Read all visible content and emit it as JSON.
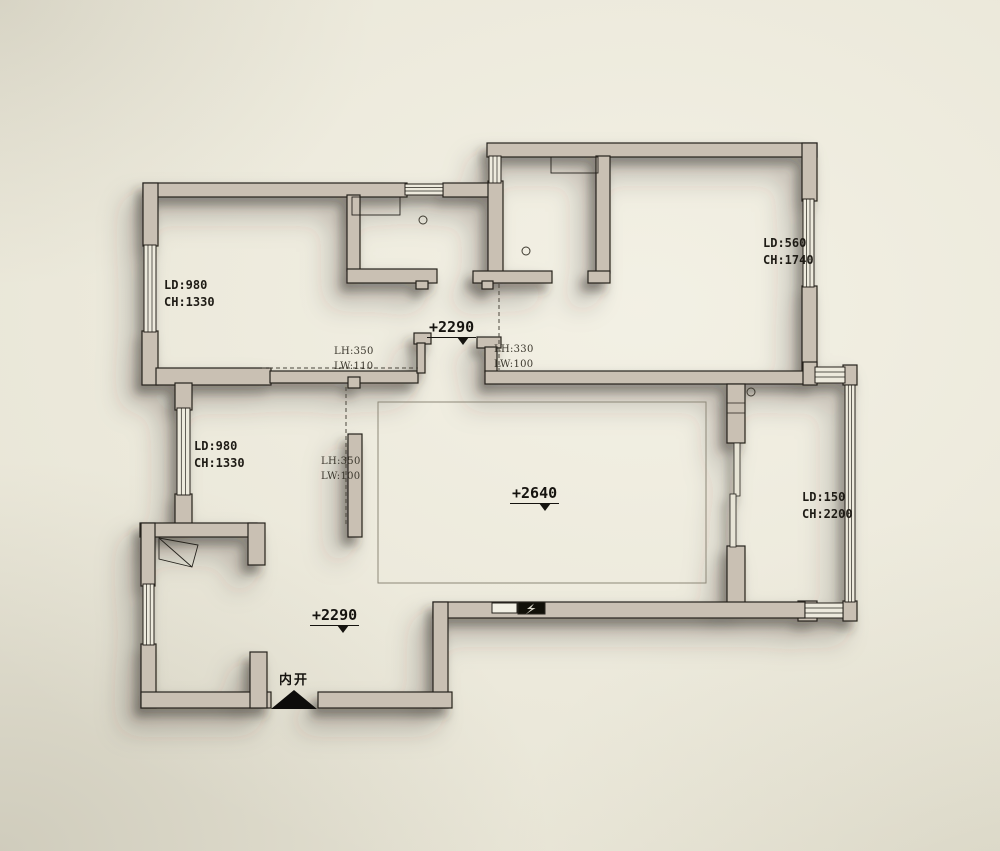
{
  "meta": {
    "drawing_type": "residential floor plan with beam/ceiling height annotations"
  },
  "colors": {
    "background": "#e8e5d6",
    "wall_fill": "#c9c0b3",
    "wall_outline": "#26231d",
    "window_fill": "#edeadd",
    "shadow": "#38332a",
    "text_dark": "#1f1c16",
    "text_dim": "#3a362c"
  },
  "labels": {
    "room_top_left": {
      "l1": "LD:980",
      "l2": "CH:1330"
    },
    "room_top_right": {
      "l1": "LD:560",
      "l2": "CH:1740"
    },
    "room_mid_left": {
      "l1": "LD:980",
      "l2": "CH:1330"
    },
    "balcony": {
      "l1": "LD:150",
      "l2": "CH:2200"
    },
    "beam_left": {
      "l1": "LH:350",
      "l2": "LW:110"
    },
    "beam_hall": {
      "l1": "LH:330",
      "l2": "LW:100"
    },
    "beam_mid": {
      "l1": "LH:350",
      "l2": "LW:100"
    },
    "door_note": "内开"
  },
  "elevations": {
    "hall_upper": "+2290",
    "living": "+2640",
    "hall_lower": "+2290"
  }
}
